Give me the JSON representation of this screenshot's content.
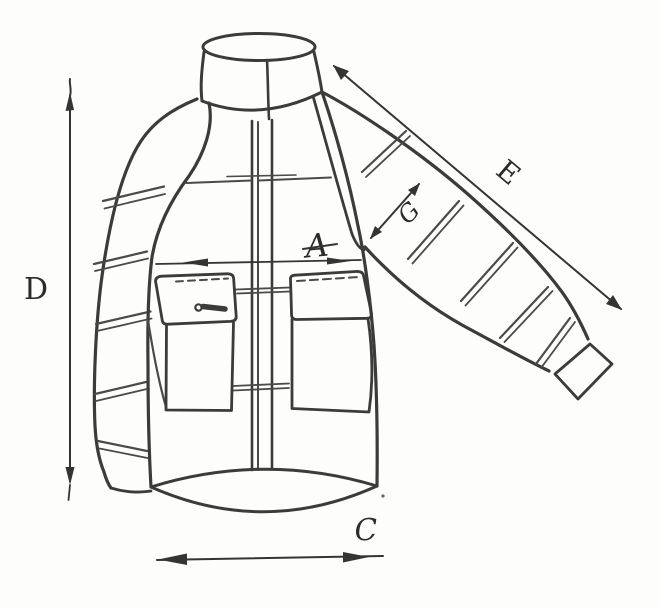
{
  "figure": {
    "kind": "hand-drawn jacket measurement sketch",
    "paper_color": "#fdfdfb",
    "ink_color": "#3b3b3b",
    "labels": {
      "chest_width": "A",
      "hem_width": "C",
      "body_length": "D",
      "sleeve_length": "E",
      "sleeve_width": "G"
    }
  }
}
